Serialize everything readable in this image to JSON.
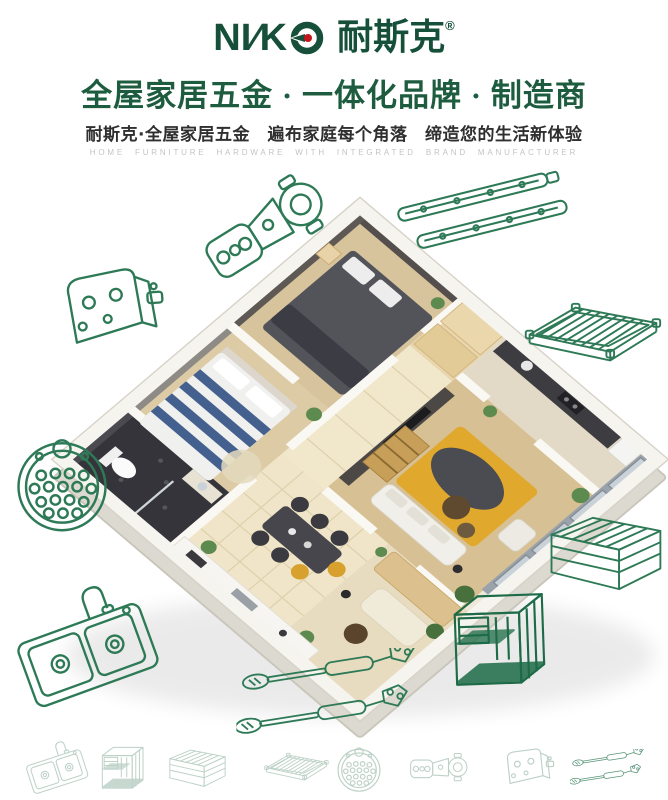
{
  "brand": {
    "latin_prefix": "NI",
    "slash": "∕",
    "latin_suffix": "K",
    "chinese": "耐斯克",
    "registered": "®"
  },
  "header": {
    "headline": "全屋家居五金 · 一体化品牌 · 制造商",
    "subheadline": "耐斯克·全屋家居五金　遍布家庭每个角落　缔造您的生活新体验",
    "tagline_en": "HOME FURNITURE HARDWARE WITH INTEGRATED BRAND MANUFACTURER"
  },
  "hero": {
    "type": "isometric-apartment-cutaway-photo",
    "rooms": [
      "master-bedroom",
      "second-bedroom",
      "living-room",
      "dining-area",
      "kitchen",
      "bathroom",
      "balcony",
      "hallway"
    ]
  },
  "hardware_lineart": {
    "stroke_color": "#2e7a57",
    "items": [
      {
        "name": "cabinet-hinge"
      },
      {
        "name": "ball-bearing-drawer-slides"
      },
      {
        "name": "hinge-mounting-plate"
      },
      {
        "name": "round-drain-basket"
      },
      {
        "name": "double-bowl-kitchen-sink"
      },
      {
        "name": "wire-shelf"
      },
      {
        "name": "wire-basket"
      },
      {
        "name": "wire-organizer-rack"
      },
      {
        "name": "gas-lift-struts"
      }
    ]
  },
  "bottom_row": {
    "items": [
      "double-bowl-kitchen-sink",
      "wire-organizer-rack",
      "wire-basket",
      "wire-shelf",
      "round-drain-basket",
      "cabinet-hinge",
      "hinge-mounting-plate",
      "gas-lift-struts"
    ]
  },
  "colors": {
    "brand_green": "#16503a",
    "logo_dot_red": "#c3151c",
    "headline_green": "#1d5c3e",
    "subheadline_gray": "#2f2f2f",
    "tagline_gray": "#c4c4c4",
    "lineart_green": "#2e7a57",
    "background": "#ffffff"
  }
}
